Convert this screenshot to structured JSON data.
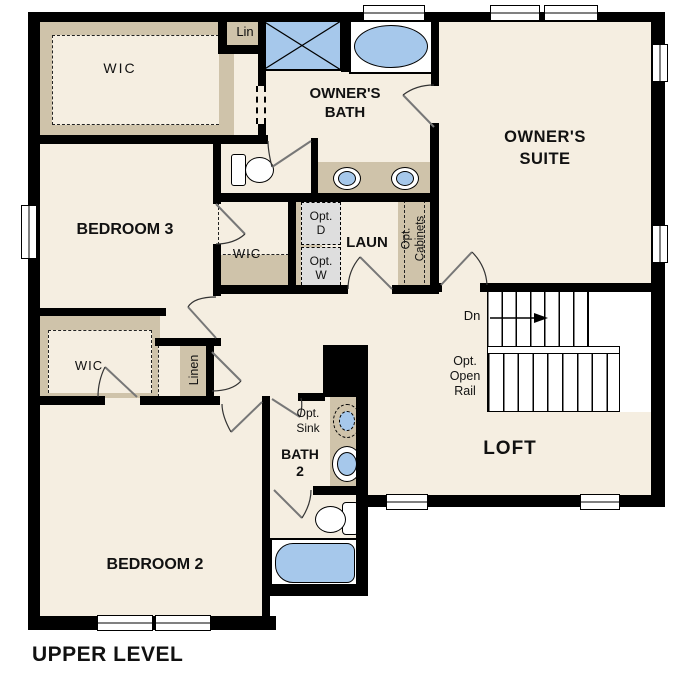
{
  "title": "UPPER LEVEL",
  "colors": {
    "floor": "#f5eee1",
    "wall": "#000000",
    "closet_shelf": "#cfc3aa",
    "fixture_blue": "#a6c8eb",
    "appliance_gray": "#dedede"
  },
  "rooms": {
    "owners_suite": {
      "line1": "OWNER'S",
      "line2": "SUITE"
    },
    "owners_bath": {
      "line1": "OWNER'S",
      "line2": "BATH"
    },
    "bedroom3": "BEDROOM 3",
    "bedroom2": "BEDROOM 2",
    "loft": "LOFT",
    "laundry": "LAUN",
    "bath2": {
      "line1": "BATH",
      "line2": "2"
    }
  },
  "closets": {
    "wic_owners": "WIC",
    "wic_bedroom3": "WIC",
    "wic_bedroom2": "WIC",
    "linen_upper": "Lin",
    "linen_hall": "Linen"
  },
  "annotations": {
    "opt_dryer": {
      "line1": "Opt.",
      "line2": "D"
    },
    "opt_washer": {
      "line1": "Opt.",
      "line2": "W"
    },
    "opt_cabinets": {
      "line1": "Opt.",
      "line2": "Cabinets"
    },
    "opt_sink": {
      "line1": "Opt.",
      "line2": "Sink"
    },
    "opt_open_rail": {
      "line1": "Opt.",
      "line2": "Open",
      "line3": "Rail"
    },
    "stairs_down": "Dn"
  }
}
